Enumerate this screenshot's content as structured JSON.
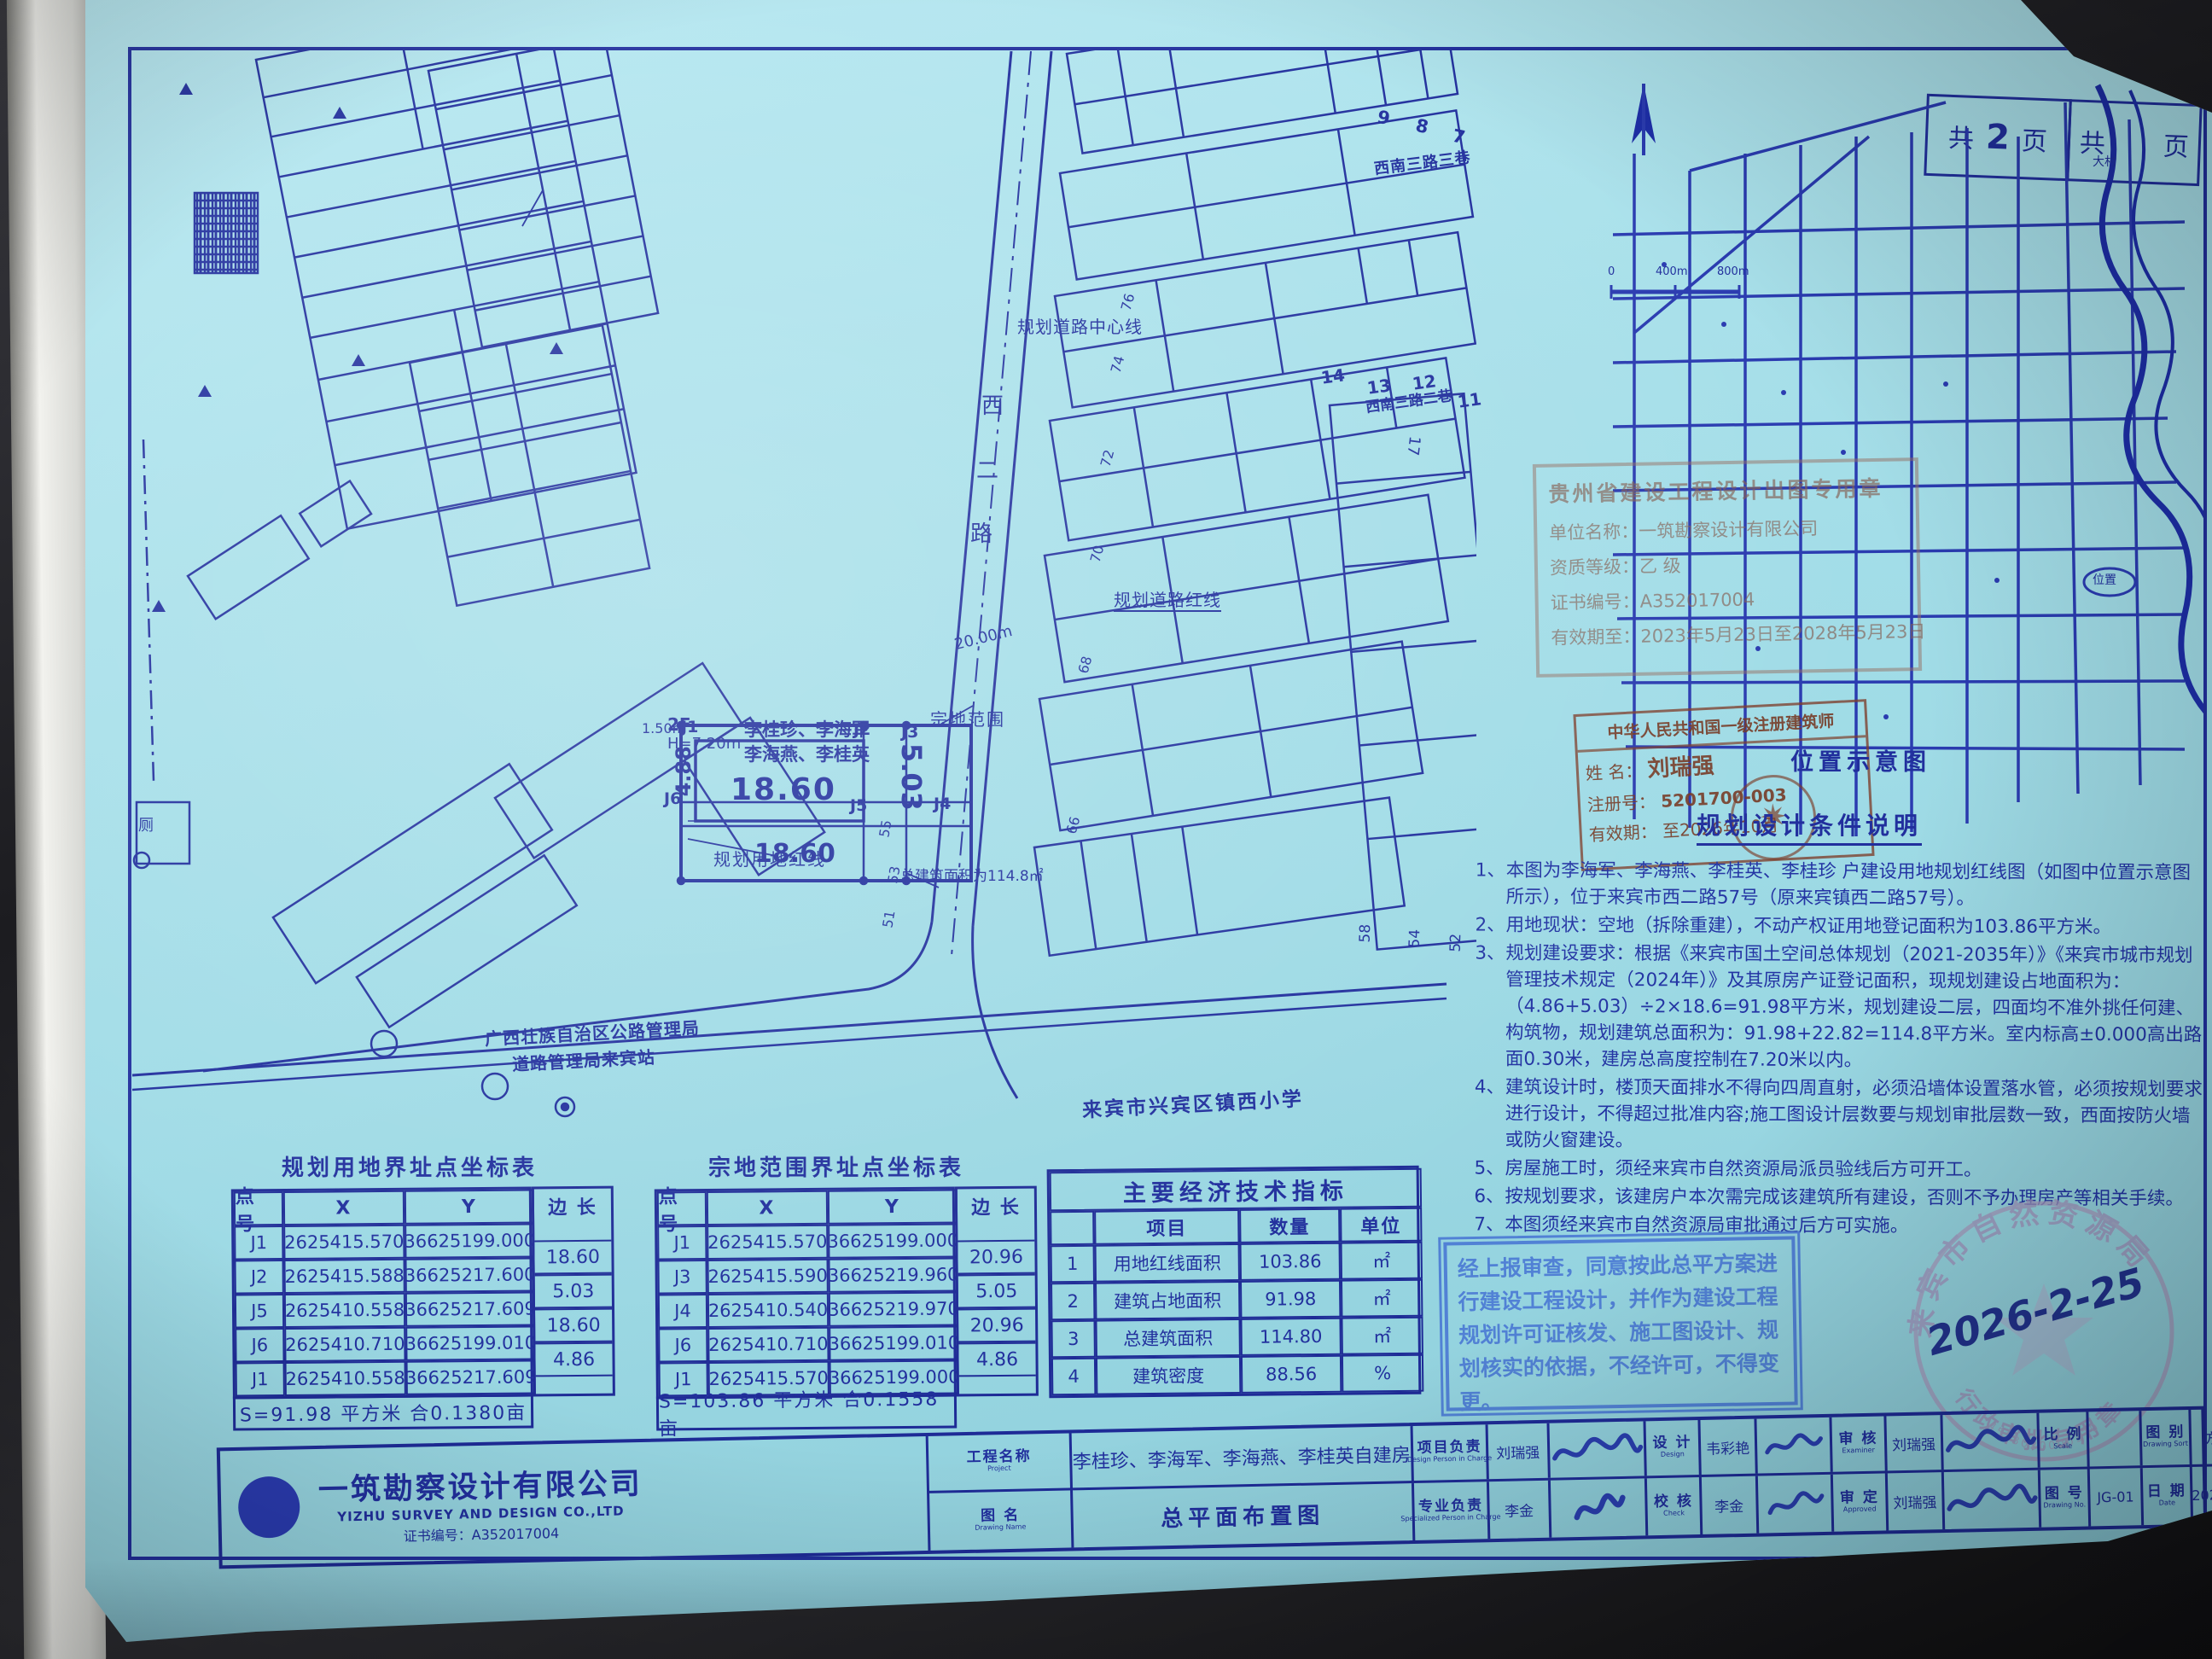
{
  "colors": {
    "sheet": "#a8e0ea",
    "line": "#212f9d",
    "stamp_red": "#7d3e2a",
    "seal_gray": "#a79cc0",
    "approval_blue": "#4a79d4"
  },
  "header": {
    "left_label": "共",
    "left_num": "2",
    "left_unit": "页",
    "right_label": "共",
    "right_unit": "页"
  },
  "map": {
    "title": "位置示意图",
    "site": "位置",
    "village": "大村",
    "scale": [
      "0",
      "400m",
      "800m"
    ]
  },
  "site_plan": {
    "road_name": [
      "西",
      "二",
      "路"
    ],
    "center_line": "规划道路中心线",
    "road_red_line": "规划道路红线",
    "land_red_line": "规划用地红线",
    "parcel_scope": "宗地范围",
    "road_width": "20.00m",
    "dim_18_top": "18.60",
    "dim_18_bottom": "18.60",
    "dim_488": "4.88",
    "dim_150": "1.50m",
    "dim_503": "5.03",
    "bldg_floors": "2F",
    "bldg_height": "H=7.20m",
    "owners1": "李桂珍、李海军",
    "owners2": "李海燕、李桂英",
    "total_area_note": "总建筑面积为114.8㎡",
    "school": "来宾市兴宾区镇西小学",
    "district_line1": "广西壮族自治区公路管理局",
    "district_line2": "道路管理局来宾站",
    "toilet": "厕",
    "pt": [
      "J1",
      "J2",
      "J3",
      "J6",
      "J5",
      "J4"
    ],
    "numbers_top": [
      "9",
      "8",
      "7"
    ],
    "alley3": "西南三路三巷",
    "numbers_mid": [
      "14",
      "13",
      "12",
      "11"
    ],
    "alley2": "西南三路二巷",
    "number_17": "17",
    "numbers_right": [
      "58",
      "54",
      "52"
    ],
    "numbers_road_east": [
      "76",
      "74",
      "72",
      "70",
      "68",
      "66"
    ],
    "numbers_road_west": [
      "55",
      "53",
      "51"
    ]
  },
  "permit_stamp": {
    "line1": "贵州省建设工程设计出图专用章",
    "line2": "单位名称：一筑勘察设计有限公司",
    "line3": "资质等级：乙 级",
    "line4": "证书编号：A352017004",
    "line5": "有效期至：2023年5月23日至2028年5月23日"
  },
  "arch_stamp": {
    "title": "中华人民共和国一级注册建筑师",
    "name_label": "姓  名：",
    "name": "刘瑞强",
    "reg_label": "注册号：",
    "reg": "5201700-003",
    "valid_label": "有效期：",
    "valid": "至2026年10月"
  },
  "notes": {
    "title": "规划设计条件说明",
    "items": [
      {
        "n": "1、",
        "t": "本图为李海军、李海燕、李桂英、李桂珍 户建设用地规划红线图（如图中位置示意图所示），位于来宾市西二路57号（原来宾镇西二路57号）。"
      },
      {
        "n": "2、",
        "t": "用地现状：空地（拆除重建），不动产权证用地登记面积为103.86平方米。"
      },
      {
        "n": "3、",
        "t": "规划建设要求：根据《来宾市国土空间总体规划（2021-2035年）》《来宾市城市规划管理技术规定（2024年）》及其原房产证登记面积，现规划建设占地面积为：（4.86+5.03）÷2×18.6=91.98平方米，规划建设二层，四面均不准外挑任何建、构筑物，规划建筑总面积为：91.98+22.82=114.8平方米。室内标高±0.000高出路面0.30米，建房总高度控制在7.20米以内。"
      },
      {
        "n": "4、",
        "t": "建筑设计时，楼顶天面排水不得向四周直射，必须沿墙体设置落水管，必须按规划要求进行设计，不得超过批准内容;施工图设计层数要与规划审批层数一致，西面按防火墙或防火窗建设。"
      },
      {
        "n": "5、",
        "t": "房屋施工时，须经来宾市自然资源局派员验线后方可开工。"
      },
      {
        "n": "6、",
        "t": "按规划要求，该建房户本次需完成该建筑所有建设，否则不予办理房产等相关手续。"
      },
      {
        "n": "7、",
        "t": "本图须经来宾市自然资源局审批通过后方可实施。"
      }
    ]
  },
  "approval_stamp": {
    "text": "经上报审查，同意按此总平方案进行建设工程设计，并作为建设工程规划许可证核发、施工图设计、规划核实的依据，不经许可，不得变更。"
  },
  "seal": {
    "top": "来宾市自然资源局",
    "bottom": "行政审批专用章",
    "serial": "4513020000370",
    "date": "2026-2-25"
  },
  "tables": {
    "t1": {
      "title": "规划用地界址点坐标表",
      "h": [
        "点 号",
        "X",
        "Y",
        "边 长"
      ],
      "rows": [
        {
          "p": "J1",
          "x": "2625415.570",
          "y": "36625199.000"
        },
        {
          "p": "J2",
          "x": "2625415.588",
          "y": "36625217.600"
        },
        {
          "p": "J5",
          "x": "2625410.558",
          "y": "36625217.609"
        },
        {
          "p": "J6",
          "x": "2625410.710",
          "y": "36625199.010"
        },
        {
          "p": "J1",
          "x": "2625410.558",
          "y": "36625217.609"
        }
      ],
      "edges": [
        "18.60",
        "5.03",
        "18.60",
        "4.86"
      ],
      "footer": "S=91.98 平方米 合0.1380亩"
    },
    "t2": {
      "title": "宗地范围界址点坐标表",
      "h": [
        "点 号",
        "X",
        "Y",
        "边 长"
      ],
      "rows": [
        {
          "p": "J1",
          "x": "2625415.570",
          "y": "36625199.000"
        },
        {
          "p": "J3",
          "x": "2625415.590",
          "y": "36625219.960"
        },
        {
          "p": "J4",
          "x": "2625410.540",
          "y": "36625219.970"
        },
        {
          "p": "J6",
          "x": "2625410.710",
          "y": "36625199.010"
        },
        {
          "p": "J1",
          "x": "2625415.570",
          "y": "36625199.000"
        }
      ],
      "edges": [
        "20.96",
        "5.05",
        "20.96",
        "4.86"
      ],
      "footer": "S=103.86 平方米 合0.1558亩"
    },
    "econ": {
      "title": "主要经济技术指标",
      "h": [
        "",
        "项目",
        "数量",
        "单位"
      ],
      "rows": [
        {
          "n": "1",
          "item": "用地红线面积",
          "qty": "103.86",
          "unit": "㎡"
        },
        {
          "n": "2",
          "item": "建筑占地面积",
          "qty": "91.98",
          "unit": "㎡"
        },
        {
          "n": "3",
          "item": "总建筑面积",
          "qty": "114.80",
          "unit": "㎡"
        },
        {
          "n": "4",
          "item": "建筑密度",
          "qty": "88.56",
          "unit": "%"
        }
      ]
    }
  },
  "titleblock": {
    "company": {
      "name": "一筑勘察设计有限公司",
      "en": "YIZHU SURVEY AND DESIGN CO.,LTD",
      "cert": "证书编号：A352017004"
    },
    "project_label": "工程名称",
    "project_en": "Project",
    "project": "李桂珍、李海军、李海燕、李桂英自建房",
    "drawing_label": "图  名",
    "drawing_en": "Drawing Name",
    "drawing": "总平面布置图",
    "r1": [
      {
        "l": "项目负责",
        "e": "Design Person in Charge",
        "v": "刘瑞强"
      },
      {
        "l": "设  计",
        "e": "Design",
        "v": "韦彩艳"
      },
      {
        "l": "审  核",
        "e": "Examiner",
        "v": "刘瑞强"
      },
      {
        "l": "比  例",
        "e": "Scale",
        "v": ""
      },
      {
        "l": "图  别",
        "e": "Drawing Sort",
        "v": "方案"
      }
    ],
    "r2": [
      {
        "l": "专业负责",
        "e": "Specialized Person in Charge",
        "v": "李金"
      },
      {
        "l": "校  核",
        "e": "Check",
        "v": "李金"
      },
      {
        "l": "审  定",
        "e": "Approved",
        "v": "刘瑞强"
      },
      {
        "l": "图  号",
        "e": "Drawing No.",
        "v": "JG-01"
      },
      {
        "l": "日  期",
        "e": "Date",
        "v": "2026.01"
      }
    ]
  }
}
